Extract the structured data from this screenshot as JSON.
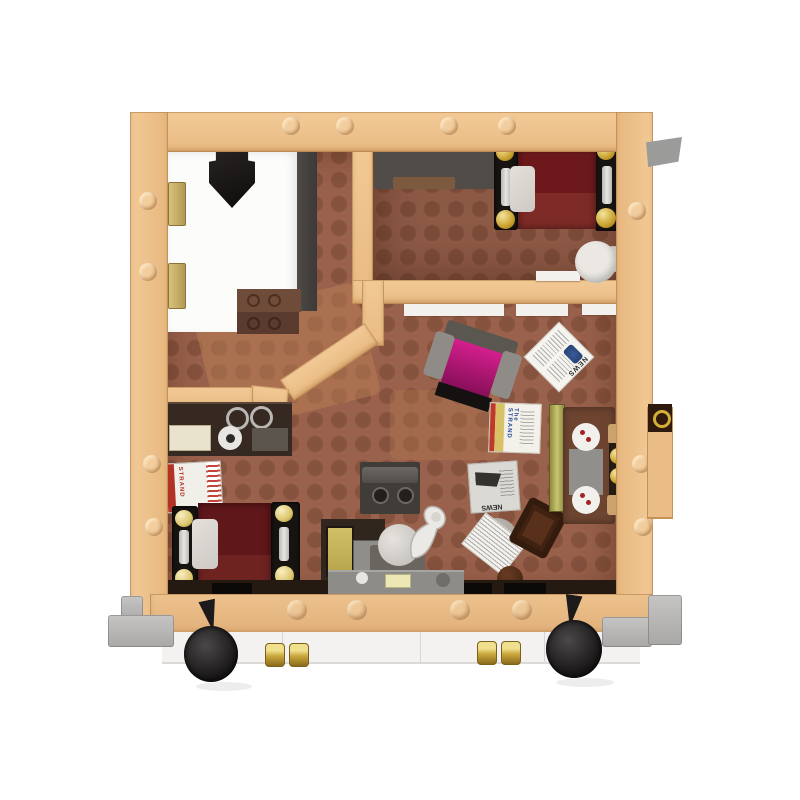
{
  "meta": {
    "title": "Brick-built apartment interior playset, top-down product photo",
    "background_color": "#ffffff"
  },
  "labels": {
    "newspaper_top": "NEWS",
    "newspaper_floor": "NEWS",
    "magazine_title": "The STRAND",
    "book_spine": "STRAND"
  },
  "palette": {
    "wall_tan": "#eec28b",
    "floor_brown": "#9a624c",
    "bedroom_floor": "#8d5a46",
    "bed_maroon": "#6d191b",
    "armchair_magenta": "#c2187e",
    "brass_gold": "#cfa93f",
    "sofa_brown": "#6c4430",
    "window_lime": "#c9c46e",
    "base_white": "#f3f2f0",
    "bumper_gray": "#b5b4b2",
    "wheel_black": "#1a1818"
  },
  "parts": {
    "rooms": [
      "white-entry-room",
      "bedroom-top",
      "living-area",
      "sleeping-corner",
      "kitchen-corner"
    ],
    "furniture": [
      "hanging-coat",
      "sideboard-strip",
      "door-mats",
      "bed-with-brass-posts",
      "round-table",
      "magenta-armchair",
      "newspaper-tiles",
      "strand-magazine",
      "book-stack",
      "shelf-unit",
      "second-bed",
      "kitchen-cabinet",
      "stove",
      "gramophone",
      "radiator-bench",
      "door-knocker"
    ],
    "base": [
      "tan-base-band",
      "white-base-plates",
      "black-wheels",
      "gold-couplers",
      "gray-bumpers"
    ]
  }
}
